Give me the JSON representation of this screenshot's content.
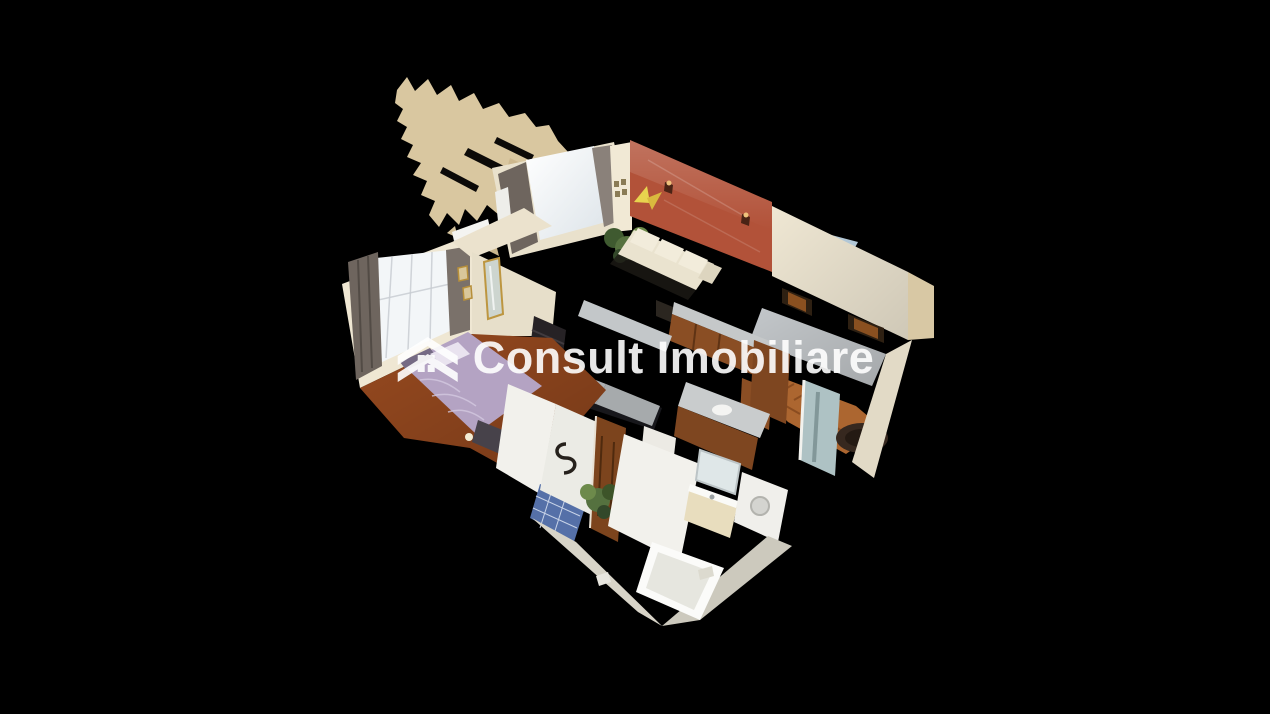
{
  "viewer": {
    "width_px": 1270,
    "height_px": 714,
    "background_color": "#000000",
    "view_mode": "dollhouse-3d-cutaway"
  },
  "watermark": {
    "text": "Consult Imobiliare",
    "color": "#ffffff",
    "opacity": 0.9,
    "logo": "house-window-logo-icon"
  },
  "model": {
    "subject": "apartment interior 3d scan, cutaway dollhouse view on black background",
    "rooms": [
      {
        "name": "bedroom",
        "features": [
          "lilac double bed",
          "bright window with sheer curtain",
          "dark gray drapes",
          "air-conditioner",
          "dark dresser",
          "gold-framed mirror",
          "red-brown wood floor"
        ]
      },
      {
        "name": "living-room",
        "features": [
          "terracotta accent wall",
          "cream sofa",
          "two wall sconces",
          "yellow butterfly decor",
          "potted plant",
          "curtained window",
          "radiator"
        ]
      },
      {
        "name": "kitchen",
        "features": [
          "wood cabinets",
          "gray countertops",
          "black hob",
          "white fridge"
        ]
      },
      {
        "name": "hallway",
        "features": [
          "herringbone parquet",
          "tall teal mirror",
          "round dark rug",
          "wood door frames"
        ]
      },
      {
        "name": "bathroom",
        "features": [
          "white bathtub",
          "vanity with sink",
          "washing machine",
          "blue mosaic floor",
          "potted plant",
          "wood door"
        ]
      }
    ],
    "artifacts": [
      "torn ceiling mesh fragment at top-left"
    ],
    "palette": {
      "mesh_tan": "#d9c7a0",
      "wall_cream": "#efe7d3",
      "wall_cut_gray": "#c3c7ca",
      "accent_wall": "#b25239",
      "curtain_gray": "#6e655e",
      "window_glow": "#f3f6f8",
      "floor_wood": "#96491f",
      "parquet_wood": "#ac6630",
      "bed_lilac": "#b4a3c3",
      "sofa_cream": "#eae3cf",
      "cabinet_wood": "#8a4e24",
      "counter_gray": "#c5c8c9",
      "stove_black": "#17171b",
      "plant_green": "#55713f",
      "mirror_teal": "#aec2c4",
      "rug_dark": "#36281f",
      "glass_blue": "#bcd2e2",
      "tile_blue": "#5570a8",
      "door_wood": "#7c441d",
      "butterfly_yellow": "#e8d44e",
      "bath_white": "#f2f1ec"
    }
  }
}
